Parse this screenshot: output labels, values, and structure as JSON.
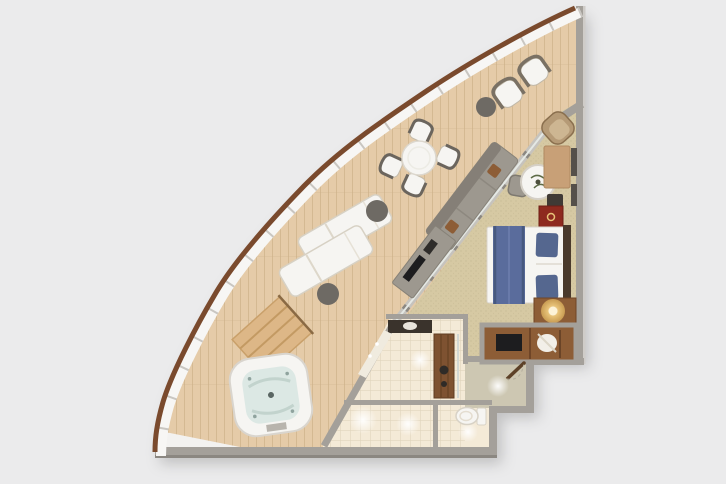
{
  "scene": {
    "description": "Aerial 3D cutaway floor plan of a curved cruise-ship suite with a wrap-around teak veranda, whirlpool spa, bedroom, sitting area, bathroom and entry hall",
    "background": "#ebebec"
  },
  "palette": {
    "bg": "#ebebec",
    "deck": "#e5cba8",
    "deckLine": "#cdb089",
    "rail": "#7a4a2d",
    "railWhite": "#f7f6f4",
    "railTick": "#c9c6c1",
    "wall": "#a4a09a",
    "wallDark": "#8b8781",
    "glassFrame": "#c6c3bd",
    "glazing": "#e4e8e4",
    "carpet": "#d6c9a3",
    "carpetDot": "#b9ac87",
    "tile": "#f4ead7",
    "hall": "#cdc7b2",
    "wood": "#8d5d36",
    "woodDark": "#6f4527",
    "woodLight": "#ddb787",
    "white": "#f6f5f2",
    "furnGray": "#9d988f",
    "furnDark": "#6e6a64",
    "dark": "#3b3733",
    "tv": "#1d1d1f",
    "blue": "#5a6c9c",
    "blueDark": "#47597f",
    "red": "#8e2a1f",
    "gold": "#e7c278",
    "water": "#dce8e4",
    "mirror": "#f0ebdf"
  },
  "areas": [
    {
      "id": "veranda",
      "label": "Wrap-around veranda deck"
    },
    {
      "id": "living-bedroom",
      "label": "Bedroom and sitting area"
    },
    {
      "id": "bathroom",
      "label": "Bathroom with vanity"
    },
    {
      "id": "shower",
      "label": "Shower"
    },
    {
      "id": "wc",
      "label": "Toilet room"
    },
    {
      "id": "entry-hall",
      "label": "Entry hall"
    },
    {
      "id": "wardrobe",
      "label": "Wardrobe closet with TV"
    }
  ],
  "furniture": [
    {
      "id": "dining-set",
      "label": "Round veranda dining table with four chairs"
    },
    {
      "id": "armchair-pair",
      "label": "Two veranda armchairs with side table"
    },
    {
      "id": "loungers",
      "label": "Two sun loungers with side tables"
    },
    {
      "id": "hot-tub",
      "label": "Private whirlpool spa with wooden steps"
    },
    {
      "id": "sofa",
      "label": "Sofa along the glass wall"
    },
    {
      "id": "tv-sideboard",
      "label": "Low sideboard with television"
    },
    {
      "id": "coffee-table",
      "label": "Round marble table with chair"
    },
    {
      "id": "desk",
      "label": "Writing desk with wall art"
    },
    {
      "id": "corner-armchair",
      "label": "Corner armchair"
    },
    {
      "id": "minibar",
      "label": "Red bedside cabinet"
    },
    {
      "id": "bed",
      "label": "Queen bed with blue runner and pillows"
    },
    {
      "id": "nightstand",
      "label": "Nightstand with glowing lamp"
    },
    {
      "id": "wardrobe-unit",
      "label": "Open wardrobe with TV and robe"
    },
    {
      "id": "vanity",
      "label": "Bathroom vanity with sink and mirror"
    },
    {
      "id": "shower-panel",
      "label": "Teak shower panel with fixtures"
    },
    {
      "id": "toilet",
      "label": "Toilet"
    },
    {
      "id": "entry-door",
      "label": "Suite entry door"
    }
  ]
}
